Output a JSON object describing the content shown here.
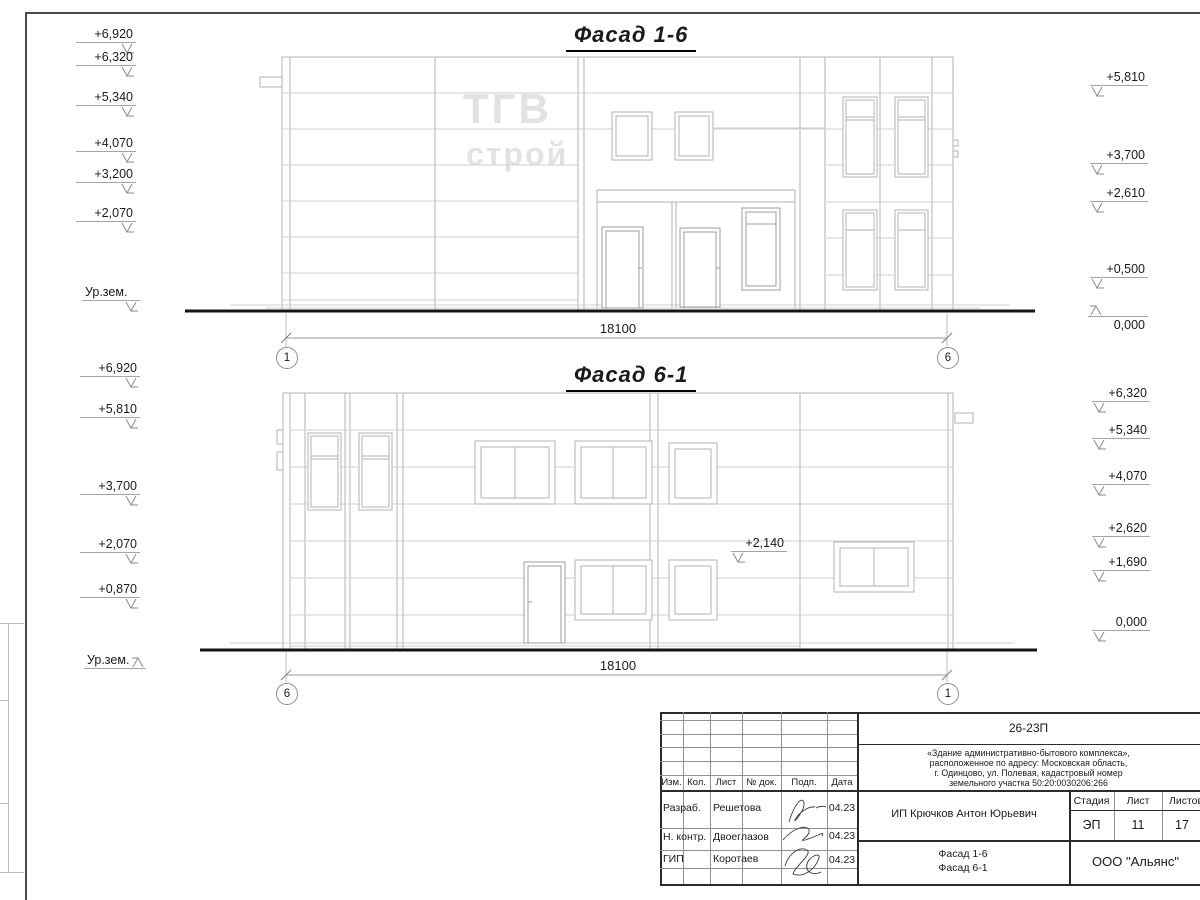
{
  "facade16": {
    "title": "Фасад 1-6",
    "logo_top": "ТГВ",
    "logo_bottom": "строй",
    "left_marks": [
      "+6,920",
      "+6,320",
      "+5,340",
      "+4,070",
      "+3,200",
      "+2,070",
      "Ур.зем."
    ],
    "right_marks": [
      "+5,810",
      "+3,700",
      "+2,610",
      "+0,500",
      "0,000"
    ],
    "dimension": "18100",
    "axis_left": "1",
    "axis_right": "6"
  },
  "facade61": {
    "title": "Фасад 6-1",
    "left_marks": [
      "+6,920",
      "+5,810",
      "+3,700",
      "+2,070",
      "+0,870",
      "Ур.зем."
    ],
    "right_marks": [
      "+6,320",
      "+5,340",
      "+4,070",
      "+2,620",
      "+1,690",
      "0,000"
    ],
    "inner_mark": "+2,140",
    "dimension": "18100",
    "axis_left": "6",
    "axis_right": "1"
  },
  "titleblock": {
    "doc_code": "26-23П",
    "project_lines": [
      "«Здание административно-бытового комплекса»,",
      "расположенное по адресу: Московская область,",
      "г. Одинцово, ул. Полевая, кадастровый номер",
      "земельного участка 50:20:0030206:266"
    ],
    "col_izm": "Изм.",
    "col_kol": "Кол.",
    "col_list": "Лист",
    "col_doc": "№ док.",
    "col_podp": "Подп.",
    "col_data": "Дата",
    "row_razrab_role": "Разраб.",
    "row_razrab_name": "Решетова",
    "row_razrab_date": "04.23",
    "row_nkontr_role": "Н. контр.",
    "row_nkontr_name": "Двоеглазов",
    "row_nkontr_date": "04.23",
    "row_gip_role": "ГИП",
    "row_gip_name": "Коротаев",
    "row_gip_date": "04.23",
    "client": "ИП Крючков Антон Юрьевич",
    "stage_label": "Стадия",
    "list_label": "Лист",
    "listov_label": "Листов",
    "stage_value": "ЭП",
    "list_value": "11",
    "listov_value": "17",
    "sheet_title_line1": "Фасад 1-6",
    "sheet_title_line2": "Фасад 6-1",
    "org": "ООО \"Альянс\""
  }
}
